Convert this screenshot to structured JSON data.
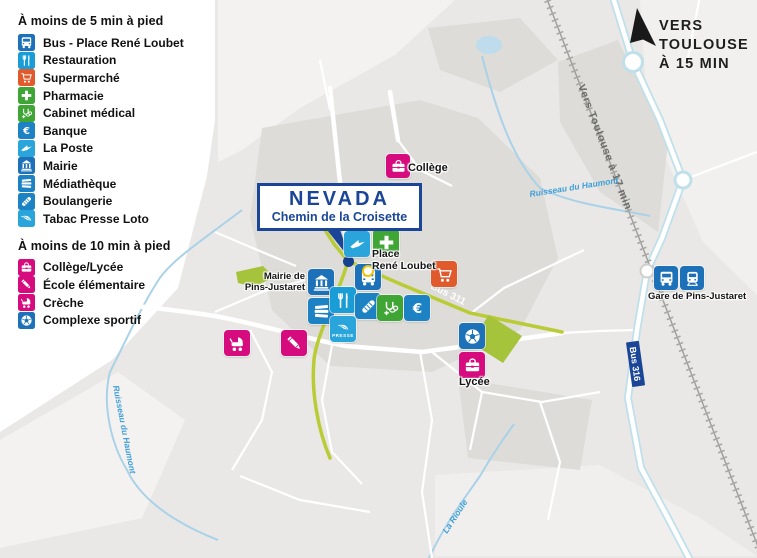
{
  "legend": {
    "sections": [
      {
        "title": "À moins de 5 min à pied",
        "items": [
          {
            "label": "Bus - Place René Loubet",
            "icon": "bus-icon",
            "color": "#1d71b8"
          },
          {
            "label": "Restauration",
            "icon": "fork-knife-icon",
            "color": "#1a9cd6"
          },
          {
            "label": "Supermarché",
            "icon": "shopping-cart-icon",
            "color": "#e05a2b"
          },
          {
            "label": "Pharmacie",
            "icon": "pharmacy-cross-icon",
            "color": "#3fa535"
          },
          {
            "label": "Cabinet médical",
            "icon": "stethoscope-icon",
            "color": "#3fa535"
          },
          {
            "label": "Banque",
            "icon": "euro-icon",
            "color": "#1d82c4"
          },
          {
            "label": "La Poste",
            "icon": "laposte-bird-icon",
            "color": "#29a5dc"
          },
          {
            "label": "Mairie",
            "icon": "town-hall-icon",
            "color": "#1d71b8"
          },
          {
            "label": "Médiathèque",
            "icon": "books-icon",
            "color": "#1d82c4"
          },
          {
            "label": "Boulangerie",
            "icon": "baguette-icon",
            "color": "#1d82c4"
          },
          {
            "label": "Tabac Presse Loto",
            "icon": "quill-icon",
            "color": "#29a5dc"
          }
        ]
      },
      {
        "title": "À moins de 10 min à pied",
        "items": [
          {
            "label": "Collège/Lycée",
            "icon": "school-bag-icon",
            "color": "#d60b7e"
          },
          {
            "label": "École élémentaire",
            "icon": "pencil-icon",
            "color": "#d60b7e"
          },
          {
            "label": "Crèche",
            "icon": "stroller-icon",
            "color": "#d60b7e"
          },
          {
            "label": "Complexe sportif",
            "icon": "football-icon",
            "color": "#1d71b8"
          }
        ]
      }
    ]
  },
  "callout": {
    "title": "NEVADA",
    "subtitle": "Chemin de la Croisette",
    "accent_color": "#1b4697"
  },
  "direction_sign": {
    "line1": "VERS",
    "line2": "TOULOUSE",
    "line3": "À 15 MIN"
  },
  "map_labels": {
    "college": "Collège",
    "place_line1": "Place",
    "place_line2": "René Loubet",
    "mairie_line1": "Mairie de",
    "mairie_line2": "Pins-Justaret",
    "gare": "Gare de Pins-Justaret",
    "lycee": "Lycée",
    "railway": "Vers Toulouse à 17 min",
    "bus_route_311": "Bus 311",
    "bus_route_316": "Bus 316",
    "stream_top": "Ruisseau du Haumont",
    "stream_left": "Ruisseau du Haumont",
    "stream_bottom": "La Rioule",
    "presse": "PRESSE"
  },
  "colors": {
    "map_base": "#e9e8e6",
    "urban": "#dddcd8",
    "light_zone": "#f3f2f0",
    "green_road": "#b9cb35",
    "water": "#a9d2e8",
    "green_area": "#a6c33c",
    "nevada_blue": "#1b4697",
    "pink": "#d60b7e"
  }
}
